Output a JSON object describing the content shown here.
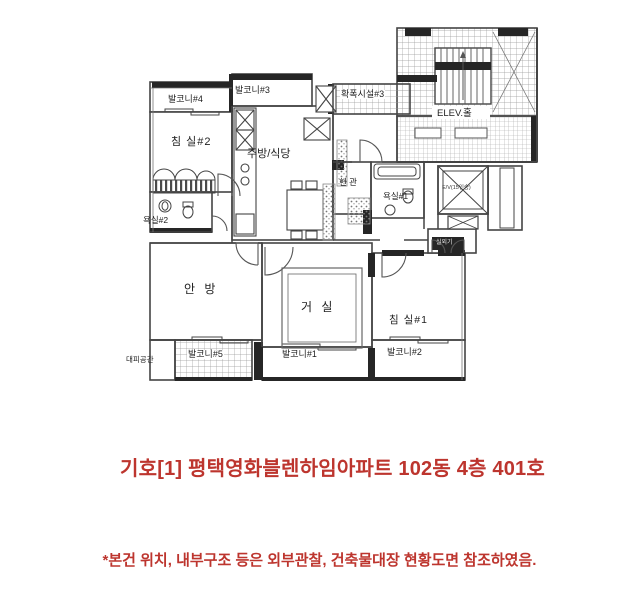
{
  "floorplan": {
    "labels": {
      "balcony4": "발코니#4",
      "bedroom2": "침 실#2",
      "balcony3": "발코니#3",
      "kitchen_dining": "주방/식당",
      "facility3": "확폭시설#3",
      "elevator_hall": "ELEV.홀",
      "entrance": "현 관",
      "bathroom1": "욕실#1",
      "bathroom2": "욕실#2",
      "master_bedroom": "안 방",
      "living_room": "거 실",
      "balcony1": "발코니#1",
      "bedroom1": "침 실#1",
      "balcony2": "발코니#2",
      "balcony5": "발코니#5",
      "refuge_space": "대피공간",
      "elevator_car": "E/V(15인승)",
      "outdoor_unit": "실외기"
    }
  },
  "captions": {
    "title": "기호[1] 평택영화블렌하임아파트 102동 4층 401호",
    "footnote": "*본건 위치, 내부구조 등은 외부관찰, 건축물대장 현황도면 참조하였음."
  },
  "colors": {
    "caption_red": "#bd352e",
    "line_dark": "#3f3f3f"
  }
}
